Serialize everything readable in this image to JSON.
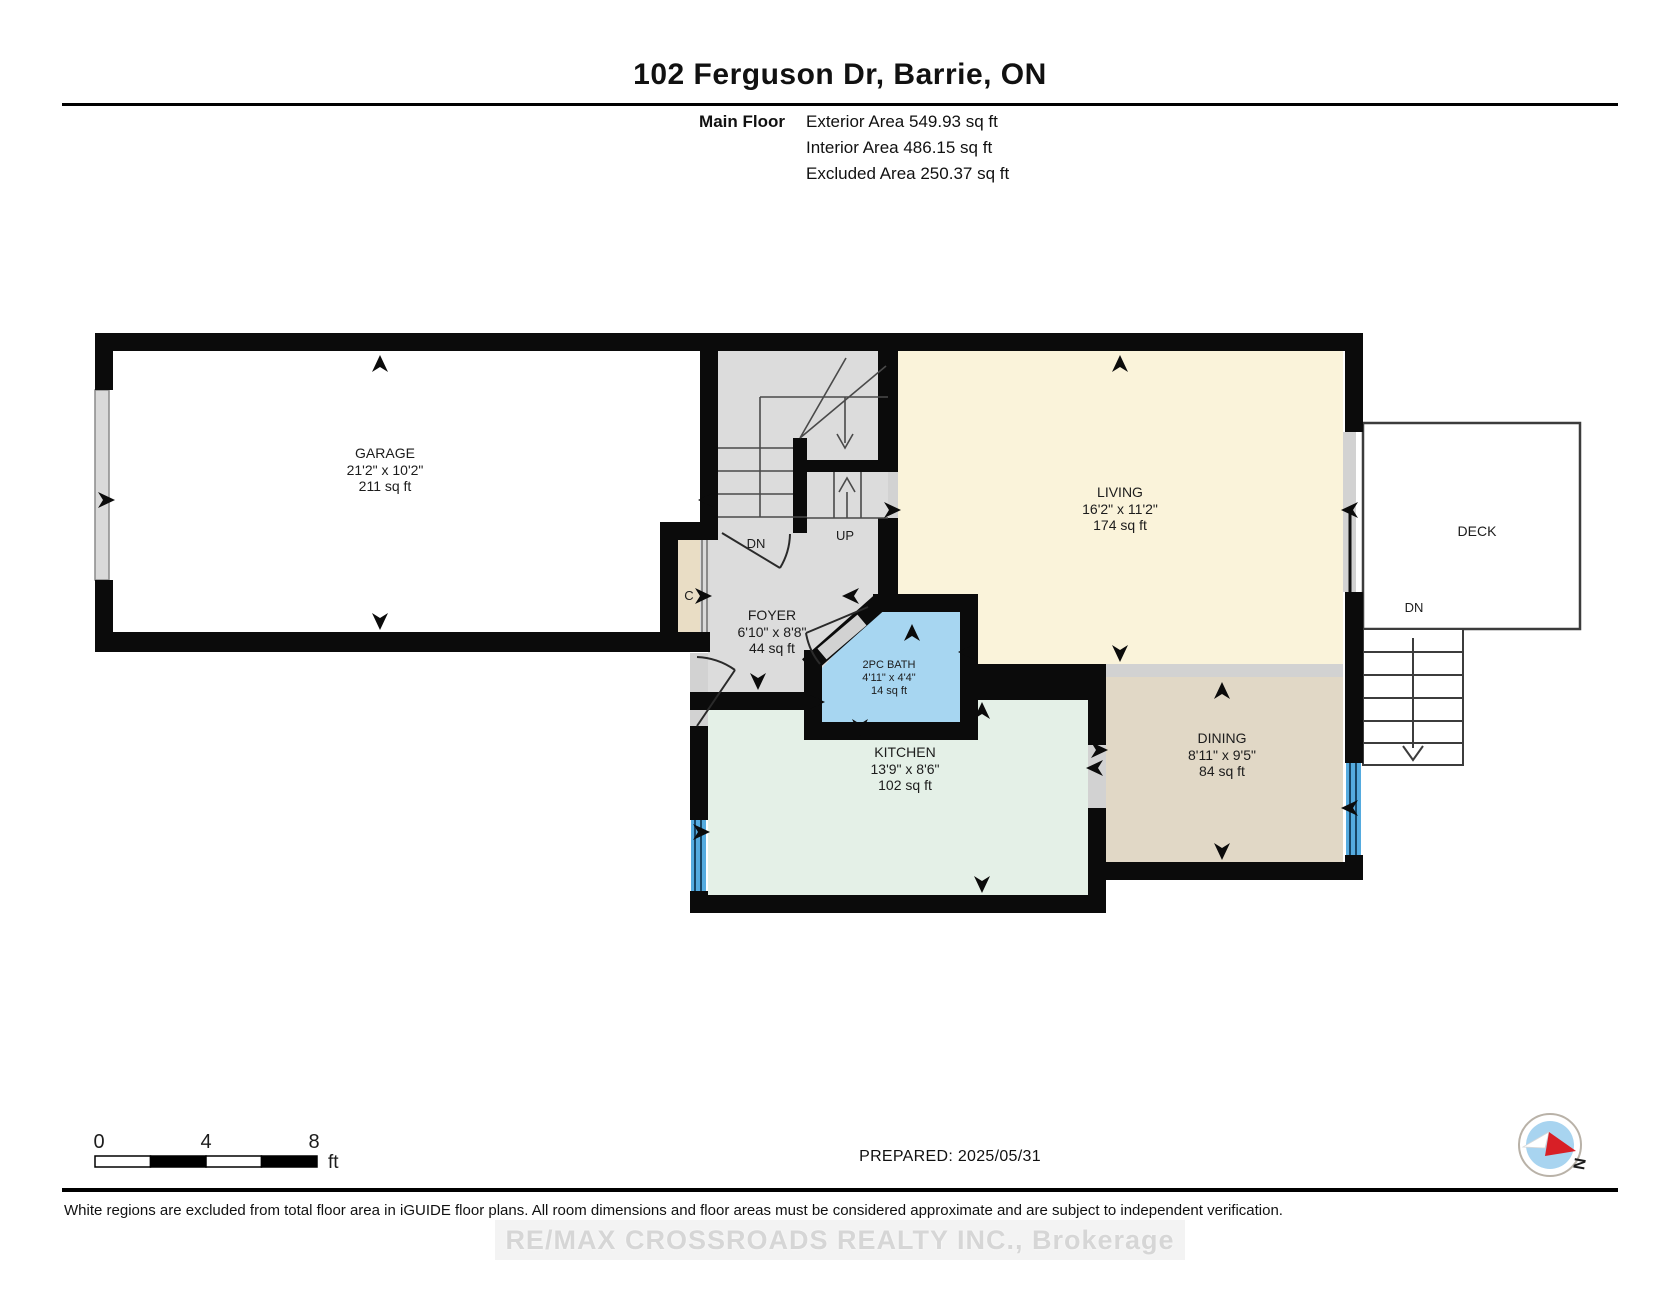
{
  "header": {
    "title": "102 Ferguson Dr, Barrie, ON",
    "floor_label": "Main Floor",
    "area_lines": [
      "Exterior Area 549.93 sq ft",
      "Interior Area 486.15 sq ft",
      "Excluded Area 250.37 sq ft"
    ]
  },
  "rooms": {
    "garage": {
      "name": "GARAGE",
      "dims": "21'2\" x 10'2\"",
      "area": "211 sq ft"
    },
    "living": {
      "name": "LIVING",
      "dims": "16'2\" x 11'2\"",
      "area": "174 sq ft"
    },
    "foyer": {
      "name": "FOYER",
      "dims": "6'10\" x 8'8\"",
      "area": "44 sq ft"
    },
    "bath": {
      "name": "2PC BATH",
      "dims": "4'11\" x 4'4\"",
      "area": "14 sq ft"
    },
    "kitchen": {
      "name": "KITCHEN",
      "dims": "13'9\" x 8'6\"",
      "area": "102 sq ft"
    },
    "dining": {
      "name": "DINING",
      "dims": "8'11\" x 9'5\"",
      "area": "84 sq ft"
    },
    "deck": {
      "name": "DECK"
    }
  },
  "plan_labels": {
    "stairs_down": "DN",
    "stairs_up": "UP",
    "deck_down": "DN",
    "closet": "C",
    "north": "N"
  },
  "scale_bar": {
    "ticks": [
      "0",
      "4",
      "8"
    ],
    "unit": "ft"
  },
  "footer": {
    "prepared": "PREPARED: 2025/05/31",
    "disclaimer": "White regions are excluded from total floor area in iGUIDE floor plans. All room dimensions and floor areas must be considered approximate and are subject to independent verification.",
    "watermark": "RE/MAX CROSSROADS REALTY INC., Brokerage"
  },
  "colors": {
    "wall": "#0b0b0b",
    "living": "#faf3da",
    "kitchen": "#e4f0e7",
    "dining": "#e1d8c6",
    "bath": "#a7d6f1",
    "hall": "#dcdcdc",
    "closet": "#e9ddc5",
    "window": "#55abdf",
    "opening": "#d2d2d2",
    "garage_door": "#d9d9d9",
    "compass_red": "#d81f26",
    "compass_blue": "#a8d4f0"
  }
}
